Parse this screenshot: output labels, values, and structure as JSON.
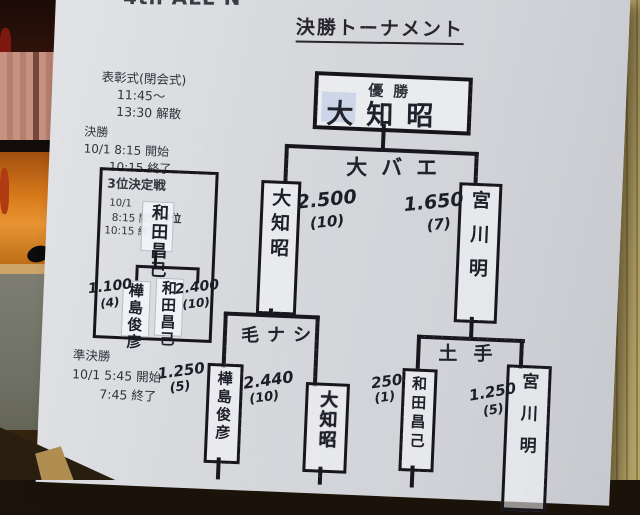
{
  "header": {
    "event_partial": "4th ALL N",
    "title": "決勝トーナメント"
  },
  "schedule": {
    "ceremony_title": "表彰式(閉会式)",
    "ceremony_time": "11:45〜",
    "ceremony_end": "13:30 解散",
    "final_label": "決勝",
    "final_line1": "10/1  8:15 開始",
    "final_line2": "10:15 終了",
    "semifinal_label": "準決勝",
    "semifinal_line1": "10/1  5:45 開始",
    "semifinal_line2": "7:45 終了"
  },
  "third_place": {
    "title": "3位決定戦",
    "date": "10/1",
    "start": "8:15 開始",
    "rank_label": "3位",
    "end": "10:15 終了",
    "winner_name": "和田昌己",
    "left_player": {
      "name": "樺島俊彦",
      "weight": "1.100",
      "fish": "(4)"
    },
    "right_player": {
      "name": "和田昌己",
      "weight": "2.400",
      "fish": "(10)"
    }
  },
  "bracket": {
    "champion_label": "優勝",
    "champion_name": "大知昭",
    "final_spot": "大バエ",
    "final_left": {
      "name": "大知昭",
      "weight": "2.500",
      "fish": "(10)"
    },
    "final_right": {
      "name": "宮川明",
      "weight": "1.650",
      "fish": "(7)"
    },
    "semi_left_spot": "毛ナシ",
    "semi_left": [
      {
        "name": "樺島俊彦",
        "weight": "1.250",
        "fish": "(5)"
      },
      {
        "name": "大知昭",
        "weight": "2.440",
        "fish": "(10)"
      }
    ],
    "semi_right_spot": "土手",
    "semi_right": [
      {
        "name": "和田昌己",
        "weight": "250",
        "fish": "(1)"
      },
      {
        "name": "宮川明",
        "weight": "1.250",
        "fish": "(5)"
      }
    ]
  },
  "colors": {
    "board": "#d6d8dc",
    "ink": "#17171d",
    "sticker": "#c7d2e6",
    "wall": "#b5a468",
    "stage": "#d97c1c",
    "curtain": "#c08573"
  }
}
